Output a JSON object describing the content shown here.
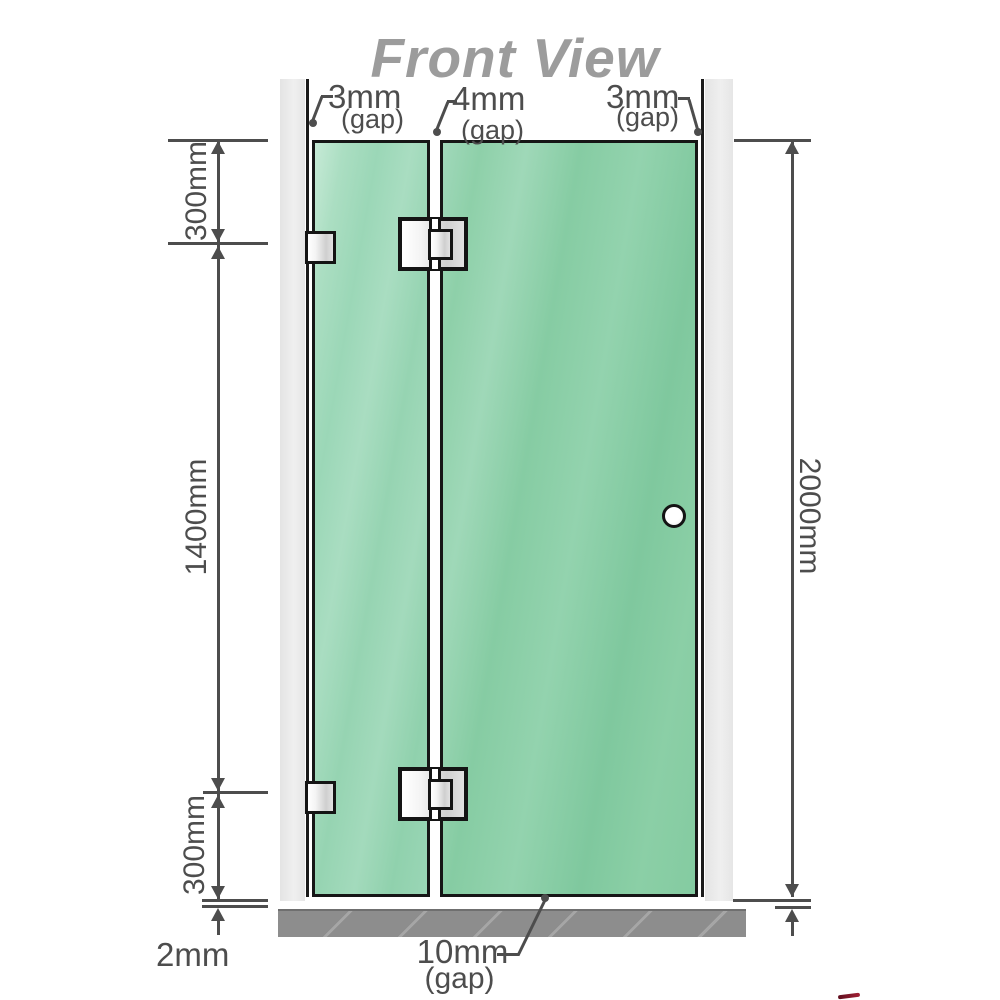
{
  "title": "Front View",
  "gap_labels": {
    "top_left": {
      "value": "3mm",
      "qualifier": "(gap)"
    },
    "top_middle": {
      "value": "4mm",
      "qualifier": "(gap)"
    },
    "top_right": {
      "value": "3mm",
      "qualifier": "(gap)"
    },
    "bottom": {
      "value": "10mm",
      "qualifier": "(gap)"
    }
  },
  "height_dimensions": {
    "left_top_segment": "300mm",
    "left_middle_segment": "1400mm",
    "left_bottom_segment": "300mm",
    "right_total": "2000mm",
    "floor_offset": "2mm"
  },
  "colors": {
    "glass_green": "#8ccfa8",
    "glass_green_light": "#a8dcc0",
    "wall_gray": "#e9e9e9",
    "floor_gray": "#8d8d8d",
    "dimension_line": "#4d4d4d",
    "title_gray": "#9c9c9c",
    "outline_black": "#161616",
    "hardware_silver": "#e0e0e0"
  }
}
